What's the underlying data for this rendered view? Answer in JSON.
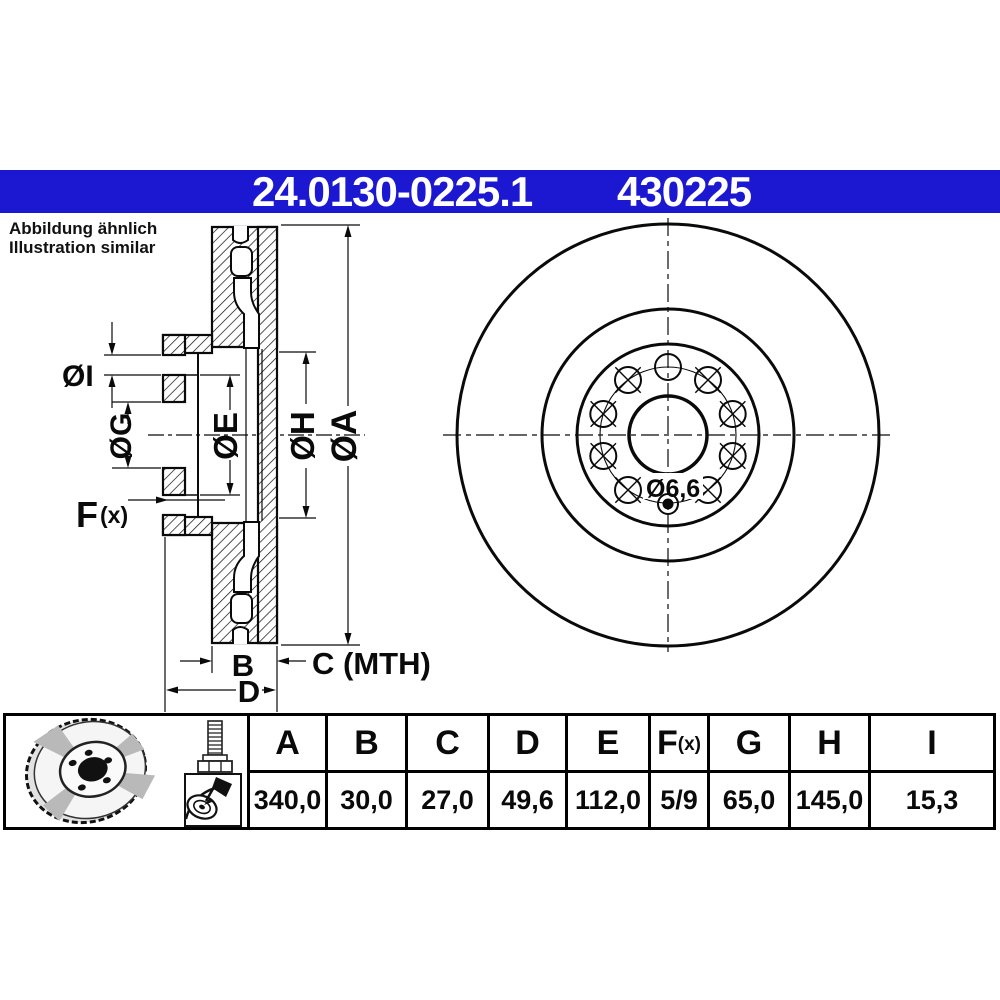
{
  "header": {
    "part_number": "24.0130-0225.1",
    "ref_number": "430225",
    "bar_color": "#1c18d2"
  },
  "note": {
    "line1": "Abbildung ähnlich",
    "line2": "Illustration similar"
  },
  "section_labels": {
    "dia_i": "ØI",
    "dia_g": "ØG",
    "dia_e": "ØE",
    "dia_h": "ØH",
    "dia_a": "ØA",
    "f_main": "F",
    "f_sub": "(x)",
    "b": "B",
    "c": "C (MTH)",
    "d": "D"
  },
  "front_labels": {
    "screw_hole": "Ø6,6"
  },
  "icons": {
    "photo": "brake-disc-photo",
    "bolt": "mounting-bolt-icon",
    "adhesive": "disc-paste-icon"
  },
  "table": {
    "columns": [
      {
        "header": "A",
        "sub": "",
        "value": "340,0"
      },
      {
        "header": "B",
        "sub": "",
        "value": "30,0"
      },
      {
        "header": "C",
        "sub": "",
        "value": "27,0"
      },
      {
        "header": "D",
        "sub": "",
        "value": "49,6"
      },
      {
        "header": "E",
        "sub": "",
        "value": "112,0"
      },
      {
        "header": "F",
        "sub": "(x)",
        "value": "5/9"
      },
      {
        "header": "G",
        "sub": "",
        "value": "65,0"
      },
      {
        "header": "H",
        "sub": "",
        "value": "145,0"
      },
      {
        "header": "I",
        "sub": "",
        "value": "15,3"
      }
    ]
  }
}
